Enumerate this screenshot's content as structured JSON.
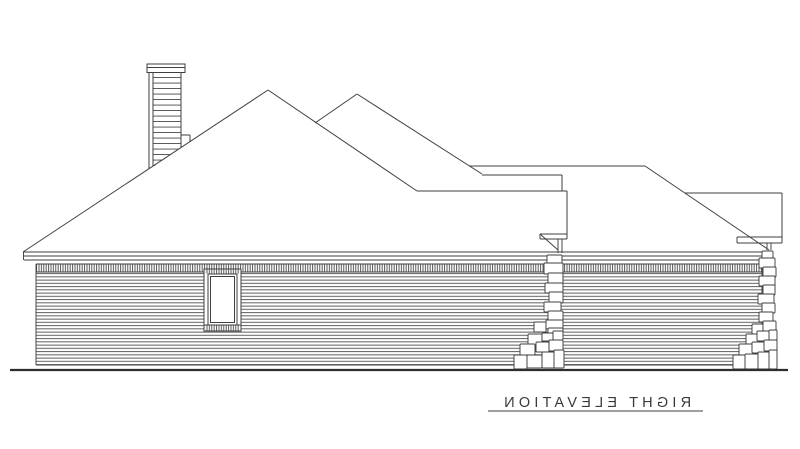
{
  "drawing": {
    "title": {
      "text": "RIGHT ELEVATION",
      "underlined": true,
      "mirrored": true
    },
    "colors": {
      "background": "#ffffff",
      "line": "#3f3f3f",
      "text": "#3a3a3a"
    }
  }
}
